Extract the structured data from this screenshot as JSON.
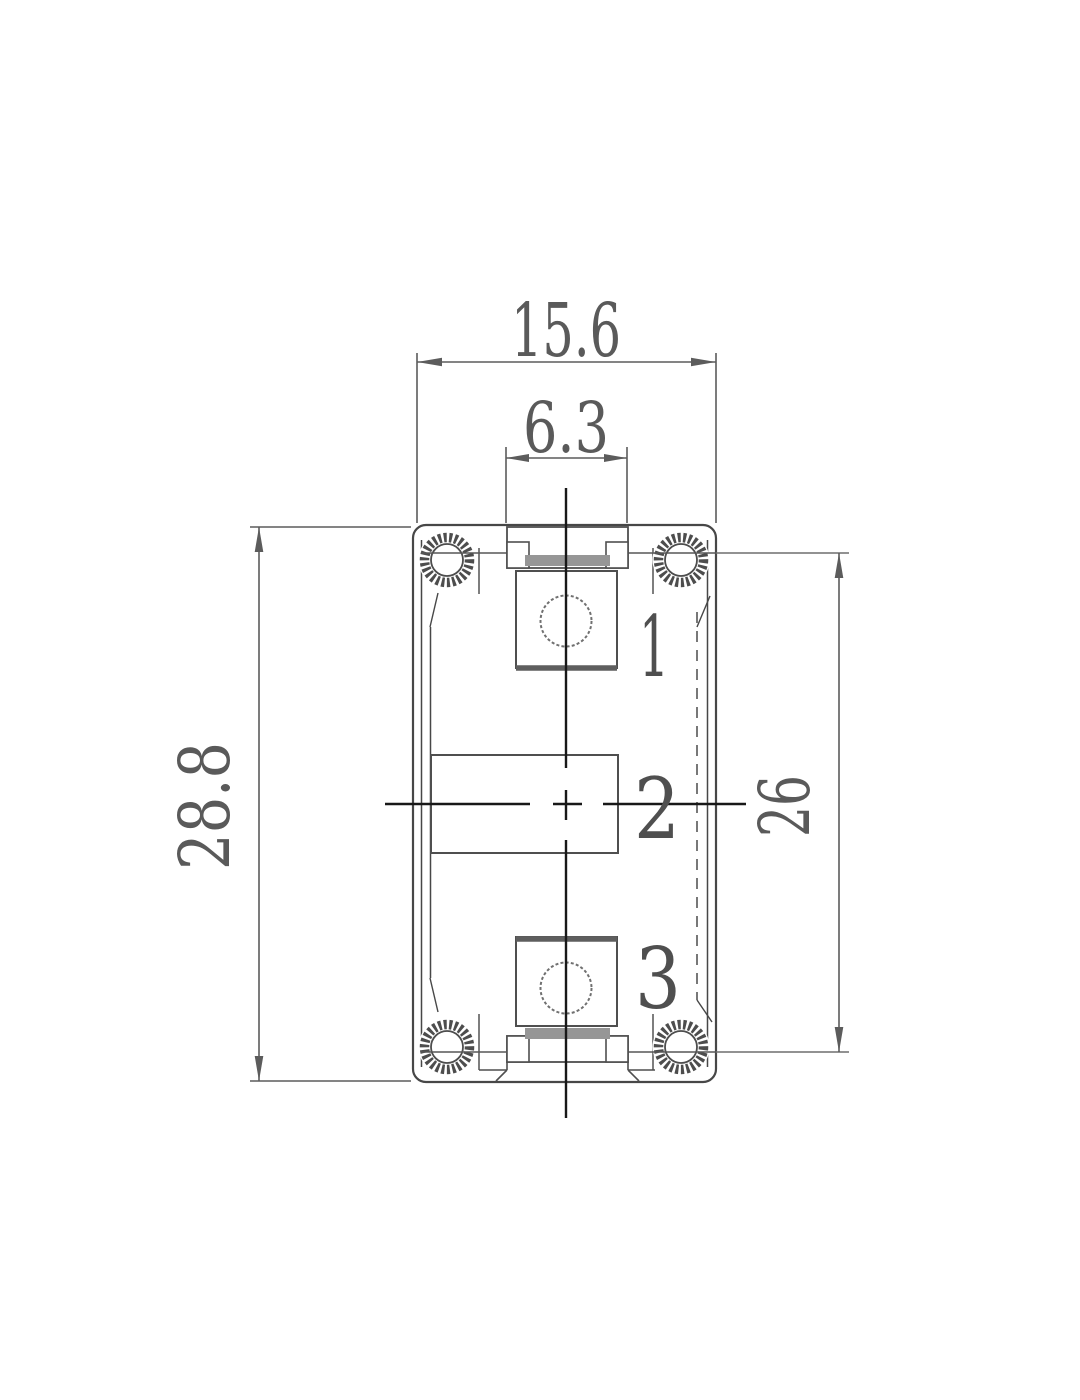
{
  "drawing": {
    "kind": "technical-dimension-drawing",
    "dimensions": {
      "overall_width": "15.6",
      "tab_width": "6.3",
      "overall_height": "28.8",
      "inner_height": "26"
    },
    "pins": [
      {
        "label": "1"
      },
      {
        "label": "2"
      },
      {
        "label": "3"
      }
    ],
    "colors": {
      "outline": "#474747",
      "centerline": "#181818",
      "dimension": "#5c5c5c",
      "hidden_line": "#616161",
      "accent_strip": "#969696",
      "background": "#ffffff"
    }
  }
}
